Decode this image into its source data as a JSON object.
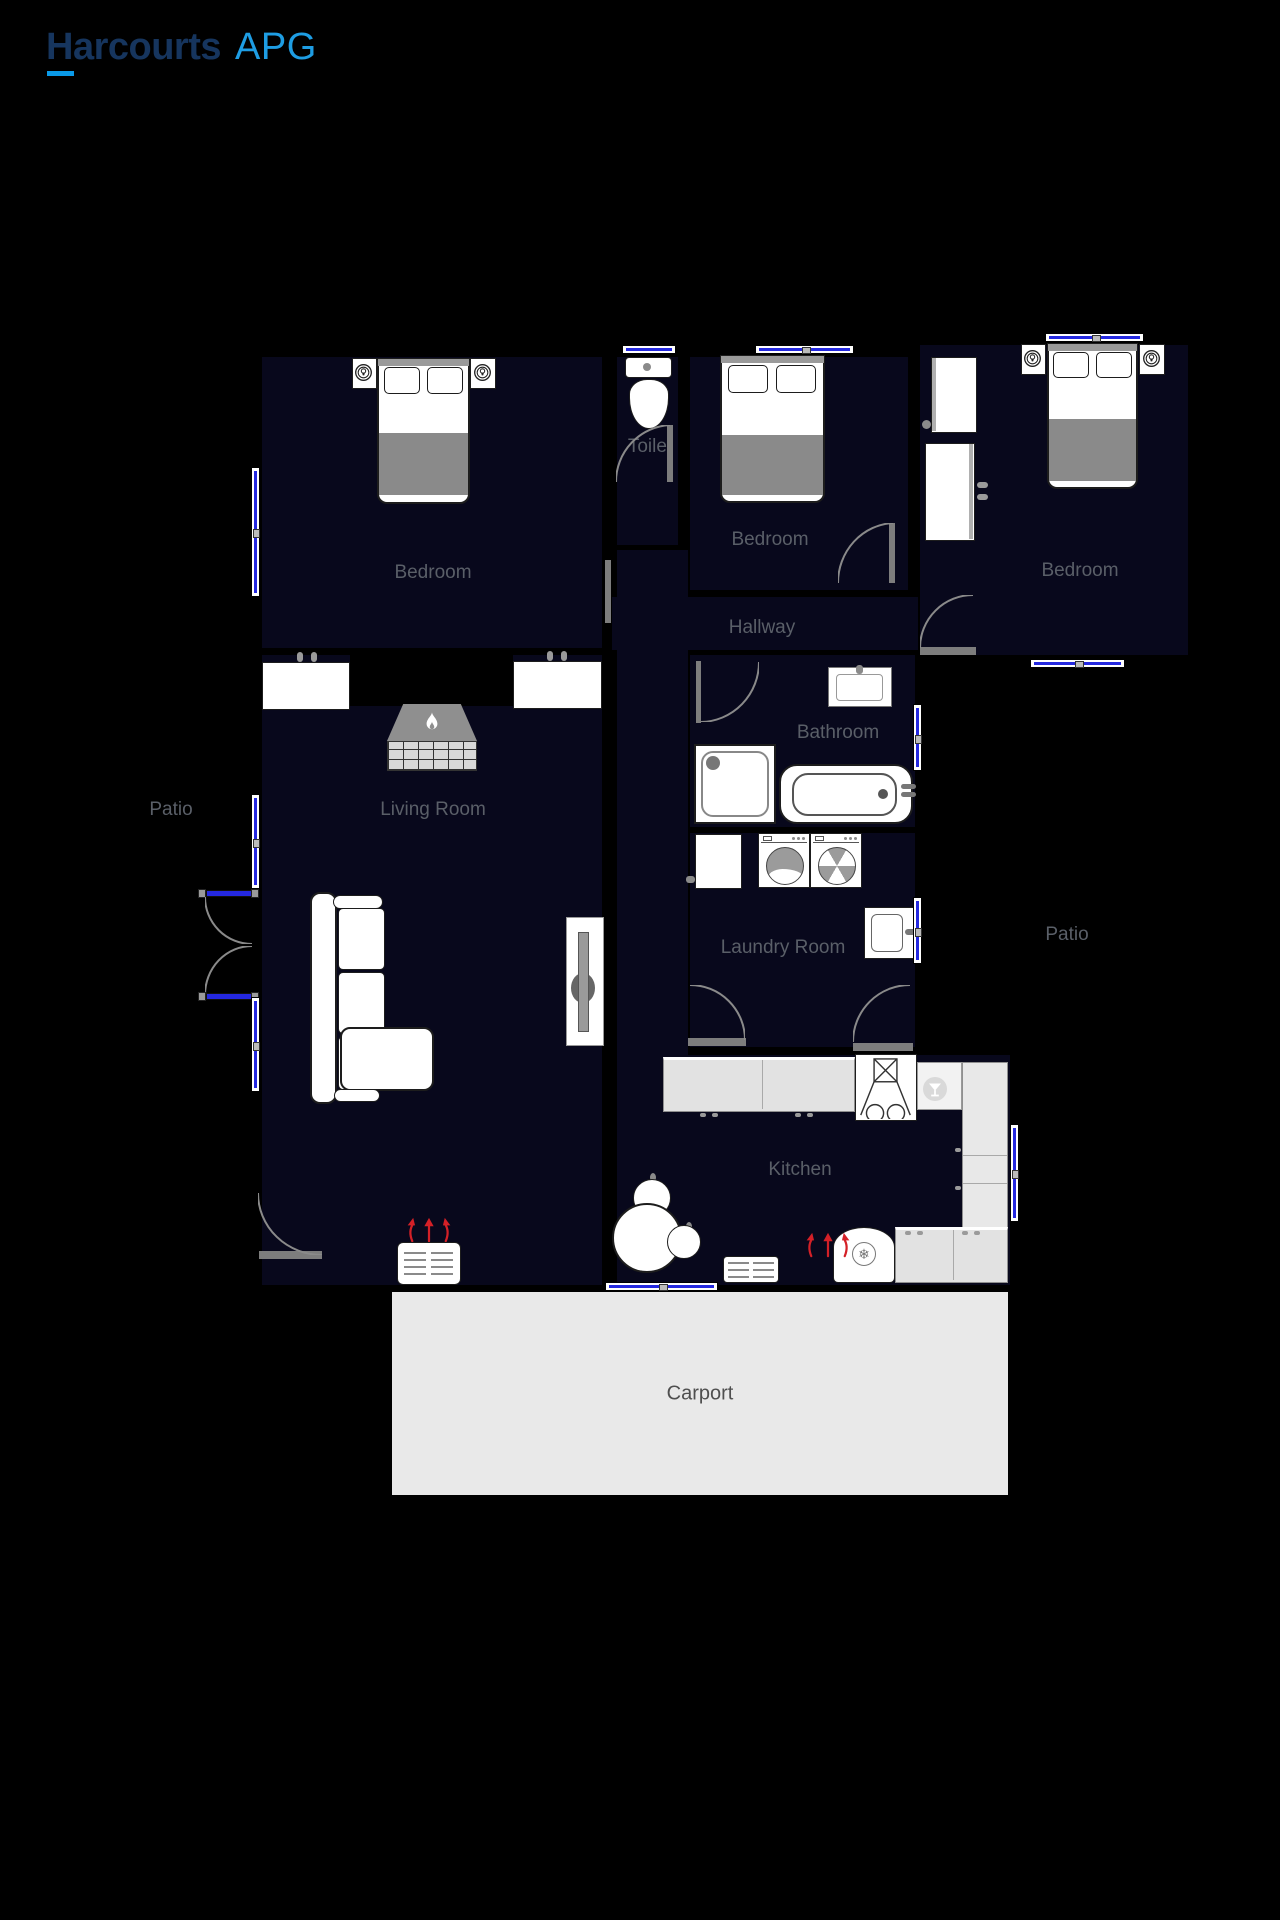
{
  "logo": {
    "brand": "Harcourts",
    "suffix": "APG"
  },
  "floorplan": {
    "rooms": {
      "bedroom1": {
        "label": "Bedroom"
      },
      "toilet": {
        "label": "Toilet"
      },
      "bedroom2": {
        "label": "Bedroom"
      },
      "bedroom3": {
        "label": "Bedroom"
      },
      "hallway": {
        "label": "Hallway"
      },
      "bathroom": {
        "label": "Bathroom"
      },
      "laundry": {
        "label": "Laundry Room"
      },
      "living": {
        "label": "Living Room"
      },
      "kitchen": {
        "label": "Kitchen"
      },
      "patio_left": {
        "label": "Patio"
      },
      "patio_right": {
        "label": "Patio"
      },
      "carport": {
        "label": "Carport"
      }
    },
    "symbols": {
      "snowflake": "❄"
    },
    "colors": {
      "background": "#000000",
      "room_fill": "#08081c",
      "room_label": "#5a5f68",
      "carport_fill": "#e9e9e9",
      "carport_label": "#4f4f4f",
      "window_glass": "#2428e0",
      "door_gray": "#7d7d7d",
      "furniture_gray": "#8f8f8f",
      "heat_arrow_red": "#d42027",
      "logo_navy": "#16355e",
      "logo_blue": "#1e9de3",
      "logo_underline": "#0a9ae8"
    }
  }
}
